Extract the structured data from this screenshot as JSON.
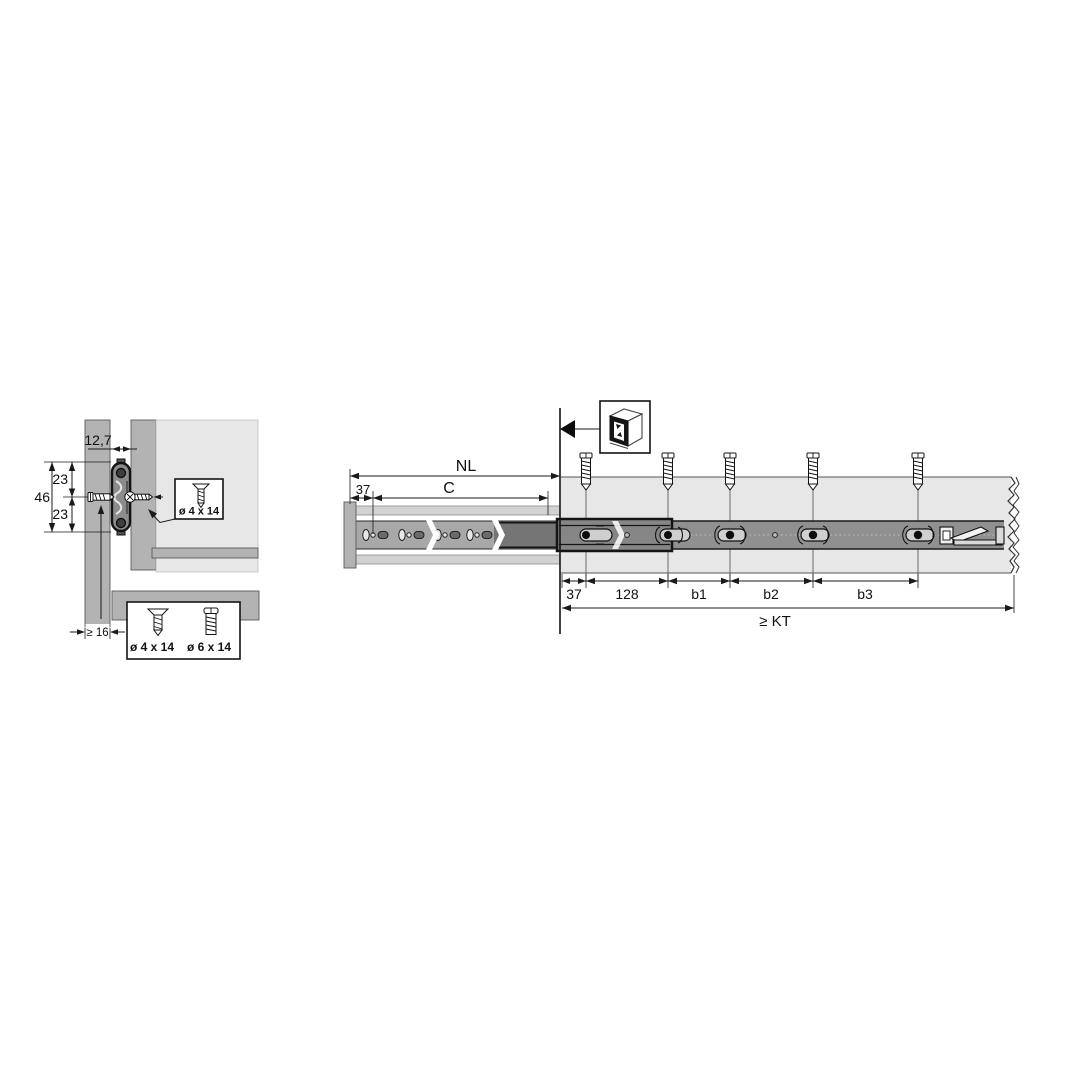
{
  "diagram": {
    "title_hint": "drawer slide mounting diagram",
    "cross_section": {
      "dim_gap": "12,7",
      "dim_upper": "23",
      "dim_lower": "23",
      "dim_total": "46",
      "dim_panel_thickness": "≥ 16",
      "screw_callout": "ø 4 x 14",
      "screw_options": [
        "ø 4 x 14",
        "ø 6 x 14"
      ]
    },
    "side_view": {
      "dim_nominal_length": "NL",
      "dim_hole_pitch": "C",
      "dim_front_offset_top": "37",
      "dim_chain": [
        "37",
        "128",
        "b1",
        "b2",
        "b3"
      ],
      "dim_cabinet_depth": "≥ KT"
    },
    "colors": {
      "panel": "#b3b3b3",
      "panel_light": "#e7e7e7",
      "rail": "#909090",
      "rail_dark": "#747474",
      "line": "#1a1a1a"
    }
  }
}
